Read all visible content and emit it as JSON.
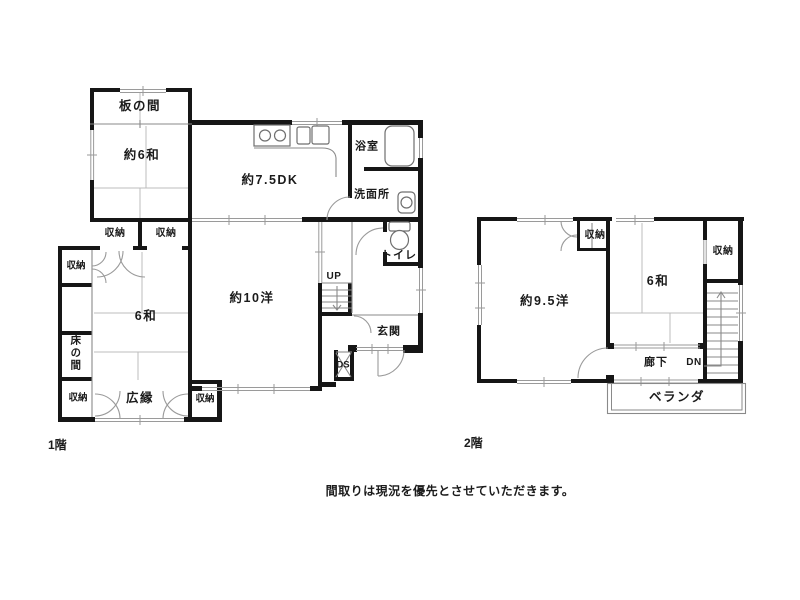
{
  "floor1": {
    "floor_label": "1階",
    "rooms": {
      "itanoma": "板の間",
      "japanese6_approx": "約6和",
      "dk": "約7.5DK",
      "bathroom": "浴室",
      "washroom": "洗面所",
      "toilet": "トイレ",
      "western10": "約10洋",
      "japanese6": "6和",
      "tokonoma": "床の間",
      "hiroen": "広縁",
      "genkan": "玄関"
    },
    "labels": {
      "up": "UP",
      "ds": "DS",
      "storage": "収納"
    }
  },
  "floor2": {
    "floor_label": "2階",
    "rooms": {
      "western95": "約9.5洋",
      "japanese6": "6和",
      "corridor": "廊下",
      "veranda": "ベランダ"
    },
    "labels": {
      "dn": "DN",
      "storage": "収納"
    }
  },
  "note": "間取りは現況を優先とさせていただきます。"
}
